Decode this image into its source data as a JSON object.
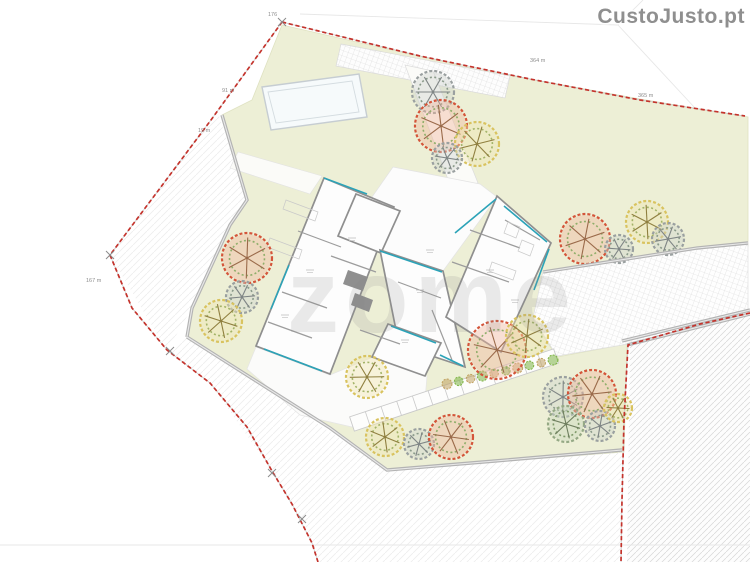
{
  "watermarks": {
    "brand": "CustoJusto.pt",
    "agency": "zome"
  },
  "palette": {
    "lawn": "#edefd6",
    "boundary_red": "#c4332c",
    "boundary_gray": "#c8c8c8",
    "wall_gray": "#b3b3b3",
    "house_wall": "#8f8f8f",
    "glazing_cyan": "#2ba3b8",
    "white": "#fdfdfd",
    "faint": "#e4e4e4"
  },
  "boundary": {
    "red_segments": [
      [
        [
          282,
          22
        ],
        [
          420,
          56
        ],
        [
          530,
          79
        ],
        [
          640,
          100
        ],
        [
          745,
          116
        ]
      ],
      [
        [
          282,
          22
        ],
        [
          211,
          120
        ],
        [
          110,
          255
        ]
      ],
      [
        [
          110,
          255
        ],
        [
          132,
          308
        ],
        [
          167,
          350
        ],
        [
          210,
          383
        ],
        [
          247,
          427
        ],
        [
          272,
          471
        ],
        [
          292,
          504
        ],
        [
          312,
          543
        ],
        [
          318,
          562
        ]
      ],
      [
        [
          750,
          313
        ],
        [
          700,
          324
        ],
        [
          628,
          345
        ],
        [
          624,
          420
        ],
        [
          622,
          500
        ],
        [
          621,
          562
        ]
      ]
    ],
    "ticks": [
      [
        282,
        22
      ],
      [
        110,
        255
      ],
      [
        170,
        351
      ],
      [
        272,
        473
      ],
      [
        302,
        519
      ]
    ],
    "labels": [
      {
        "t": "176",
        "x": 268,
        "y": 16
      },
      {
        "t": "91 m",
        "x": 222,
        "y": 92
      },
      {
        "t": "19 m",
        "x": 198,
        "y": 132
      },
      {
        "t": "167 m",
        "x": 86,
        "y": 282
      },
      {
        "t": "364 m",
        "x": 530,
        "y": 62
      },
      {
        "t": "365 m",
        "x": 638,
        "y": 97
      }
    ],
    "faint_lines": [
      [
        [
          300,
          14
        ],
        [
          618,
          25
        ]
      ],
      [
        [
          618,
          25
        ],
        [
          695,
          108
        ]
      ],
      [
        [
          618,
          25
        ],
        [
          643,
          0
        ]
      ],
      [
        [
          0,
          545
        ],
        [
          750,
          545
        ]
      ]
    ]
  },
  "site": {
    "lawn": [
      [
        282,
        25
      ],
      [
        480,
        70
      ],
      [
        640,
        99
      ],
      [
        748,
        117
      ],
      [
        748,
        246
      ],
      [
        543,
        272
      ],
      [
        533,
        320
      ],
      [
        557,
        357
      ],
      [
        627,
        344
      ],
      [
        624,
        452
      ],
      [
        387,
        470
      ],
      [
        330,
        428
      ],
      [
        187,
        337
      ],
      [
        192,
        308
      ],
      [
        230,
        225
      ],
      [
        247,
        200
      ],
      [
        222,
        115
      ],
      [
        252,
        100
      ]
    ],
    "hatch_wedge": [
      [
        218,
        113
      ],
      [
        247,
        200
      ],
      [
        192,
        308
      ],
      [
        167,
        351
      ],
      [
        110,
        255
      ],
      [
        211,
        120
      ]
    ],
    "hatch_bottom": [
      [
        187,
        337
      ],
      [
        387,
        470
      ],
      [
        622,
        450
      ],
      [
        622,
        562
      ],
      [
        318,
        562
      ],
      [
        312,
        543
      ],
      [
        272,
        471
      ],
      [
        210,
        383
      ],
      [
        167,
        351
      ]
    ],
    "parcel_right": [
      [
        630,
        346
      ],
      [
        750,
        315
      ],
      [
        750,
        562
      ],
      [
        627,
        562
      ]
    ],
    "terrace_grid": [
      [
        543,
        272
      ],
      [
        748,
        242
      ],
      [
        748,
        312
      ],
      [
        628,
        344
      ],
      [
        557,
        356
      ],
      [
        533,
        318
      ]
    ],
    "parking_strip": [
      [
        341,
        44
      ],
      [
        510,
        76
      ],
      [
        505,
        98
      ],
      [
        336,
        66
      ]
    ],
    "driveway": [
      [
        405,
        65
      ],
      [
        433,
        71
      ],
      [
        478,
        183
      ],
      [
        452,
        190
      ]
    ],
    "west_path": [
      [
        238,
        152
      ],
      [
        322,
        176
      ],
      [
        310,
        194
      ],
      [
        230,
        168
      ]
    ],
    "terrace_north": [
      [
        393,
        167
      ],
      [
        480,
        184
      ],
      [
        497,
        197
      ],
      [
        443,
        271
      ],
      [
        381,
        251
      ],
      [
        372,
        197
      ]
    ],
    "patio_south": [
      [
        256,
        347
      ],
      [
        330,
        375
      ],
      [
        373,
        357
      ],
      [
        427,
        376
      ],
      [
        425,
        400
      ],
      [
        352,
        427
      ],
      [
        300,
        415
      ],
      [
        247,
        369
      ]
    ],
    "pool": {
      "outer": [
        [
          262,
          87
        ],
        [
          359,
          74
        ],
        [
          367,
          117
        ],
        [
          271,
          130
        ]
      ],
      "inner": [
        [
          268,
          92
        ],
        [
          352,
          81
        ],
        [
          359,
          112
        ],
        [
          276,
          123
        ]
      ]
    },
    "stairs": {
      "start": [
        352,
        424
      ],
      "end": [
        556,
        356
      ],
      "width": 15,
      "steps": 13
    },
    "walls": [
      [
        [
          222,
          115
        ],
        [
          247,
          200
        ],
        [
          230,
          225
        ],
        [
          192,
          308
        ],
        [
          187,
          337
        ]
      ],
      [
        [
          187,
          337
        ],
        [
          330,
          428
        ],
        [
          387,
          470
        ],
        [
          495,
          461
        ],
        [
          622,
          450
        ]
      ],
      [
        [
          622,
          341
        ],
        [
          700,
          322
        ],
        [
          750,
          310
        ]
      ],
      [
        [
          543,
          272
        ],
        [
          697,
          248
        ],
        [
          748,
          243
        ]
      ],
      [
        [
          627,
          345
        ],
        [
          750,
          314
        ]
      ]
    ],
    "house": {
      "wings": [
        [
          [
            324,
            178
          ],
          [
            394,
            207
          ],
          [
            330,
            374
          ],
          [
            256,
            346
          ]
        ],
        [
          [
            356,
            194
          ],
          [
            400,
            211
          ],
          [
            381,
            253
          ],
          [
            338,
            236
          ]
        ],
        [
          [
            380,
            250
          ],
          [
            443,
            271
          ],
          [
            465,
            367
          ],
          [
            399,
            345
          ]
        ],
        [
          [
            497,
            196
          ],
          [
            551,
            243
          ],
          [
            501,
            352
          ],
          [
            446,
            317
          ]
        ],
        [
          [
            388,
            324
          ],
          [
            441,
            343
          ],
          [
            425,
            376
          ],
          [
            372,
            357
          ]
        ]
      ],
      "cores": [
        [
          [
            348,
            270
          ],
          [
            368,
            277
          ],
          [
            363,
            291
          ],
          [
            343,
            284
          ]
        ],
        [
          [
            355,
            293
          ],
          [
            373,
            300
          ],
          [
            369,
            312
          ],
          [
            351,
            305
          ]
        ]
      ],
      "interior_walls": [
        [
          [
            331,
            256
          ],
          [
            376,
            272
          ]
        ],
        [
          [
            298,
            231
          ],
          [
            341,
            247
          ]
        ],
        [
          [
            282,
            292
          ],
          [
            327,
            308
          ]
        ],
        [
          [
            268,
            322
          ],
          [
            312,
            338
          ]
        ],
        [
          [
            398,
            282
          ],
          [
            441,
            298
          ]
        ],
        [
          [
            452,
            262
          ],
          [
            509,
            282
          ]
        ],
        [
          [
            470,
            230
          ],
          [
            520,
            248
          ]
        ],
        [
          [
            360,
            330
          ],
          [
            400,
            344
          ]
        ],
        [
          [
            432,
            310
          ],
          [
            452,
            360
          ]
        ],
        [
          [
            505,
            220
          ],
          [
            540,
            240
          ]
        ]
      ],
      "fixtures": [
        [
          [
            508,
            222
          ],
          [
            520,
            227
          ],
          [
            516,
            238
          ],
          [
            504,
            233
          ]
        ],
        [
          [
            522,
            240
          ],
          [
            534,
            245
          ],
          [
            530,
            256
          ],
          [
            518,
            251
          ]
        ],
        [
          [
            492,
            262
          ],
          [
            516,
            271
          ],
          [
            513,
            280
          ],
          [
            489,
            271
          ]
        ],
        [
          [
            286,
            200
          ],
          [
            318,
            212
          ],
          [
            315,
            221
          ],
          [
            283,
            209
          ]
        ],
        [
          [
            270,
            238
          ],
          [
            302,
            250
          ],
          [
            299,
            259
          ],
          [
            267,
            247
          ]
        ]
      ],
      "glazing": [
        [
          [
            324,
            178
          ],
          [
            367,
            194
          ]
        ],
        [
          [
            380,
            251
          ],
          [
            442,
            272
          ]
        ],
        [
          [
            391,
            326
          ],
          [
            436,
            343
          ]
        ],
        [
          [
            289,
            265
          ],
          [
            271,
            309
          ]
        ],
        [
          [
            264,
            349
          ],
          [
            322,
            371
          ]
        ],
        [
          [
            455,
            233
          ],
          [
            496,
            199
          ]
        ],
        [
          [
            504,
            206
          ],
          [
            547,
            242
          ]
        ],
        [
          [
            549,
            249
          ],
          [
            534,
            290
          ]
        ],
        [
          [
            440,
            355
          ],
          [
            463,
            366
          ]
        ]
      ],
      "room_marks": [
        [
          352,
          238
        ],
        [
          310,
          270
        ],
        [
          285,
          315
        ],
        [
          420,
          290
        ],
        [
          490,
          270
        ],
        [
          515,
          300
        ],
        [
          405,
          340
        ],
        [
          430,
          250
        ]
      ]
    },
    "trees": [
      {
        "x": 433,
        "y": 92,
        "r": 21,
        "type": "gray"
      },
      {
        "x": 441,
        "y": 126,
        "r": 26,
        "type": "red"
      },
      {
        "x": 477,
        "y": 144,
        "r": 22,
        "type": "yellow"
      },
      {
        "x": 447,
        "y": 158,
        "r": 15,
        "type": "gray"
      },
      {
        "x": 247,
        "y": 258,
        "r": 25,
        "type": "red"
      },
      {
        "x": 242,
        "y": 297,
        "r": 16,
        "type": "gray"
      },
      {
        "x": 221,
        "y": 321,
        "r": 21,
        "type": "yellow"
      },
      {
        "x": 585,
        "y": 239,
        "r": 25,
        "type": "red"
      },
      {
        "x": 619,
        "y": 249,
        "r": 14,
        "type": "gray"
      },
      {
        "x": 647,
        "y": 222,
        "r": 21,
        "type": "yellow"
      },
      {
        "x": 668,
        "y": 239,
        "r": 16,
        "type": "gray"
      },
      {
        "x": 497,
        "y": 350,
        "r": 29,
        "type": "red"
      },
      {
        "x": 527,
        "y": 336,
        "r": 21,
        "type": "yellow"
      },
      {
        "x": 367,
        "y": 377,
        "r": 21,
        "type": "yellow"
      },
      {
        "x": 385,
        "y": 437,
        "r": 19,
        "type": "yellow"
      },
      {
        "x": 419,
        "y": 444,
        "r": 15,
        "type": "gray"
      },
      {
        "x": 451,
        "y": 437,
        "r": 22,
        "type": "red"
      },
      {
        "x": 563,
        "y": 397,
        "r": 20,
        "type": "gray"
      },
      {
        "x": 592,
        "y": 394,
        "r": 24,
        "type": "red"
      },
      {
        "x": 566,
        "y": 424,
        "r": 18,
        "type": "graygreen"
      },
      {
        "x": 600,
        "y": 426,
        "r": 15,
        "type": "gray"
      },
      {
        "x": 618,
        "y": 408,
        "r": 14,
        "type": "yellow"
      }
    ],
    "bushes": {
      "from": [
        447,
        384
      ],
      "to": [
        553,
        360
      ],
      "count": 10,
      "colors": [
        "#c0a05e",
        "#7cb342"
      ]
    }
  }
}
